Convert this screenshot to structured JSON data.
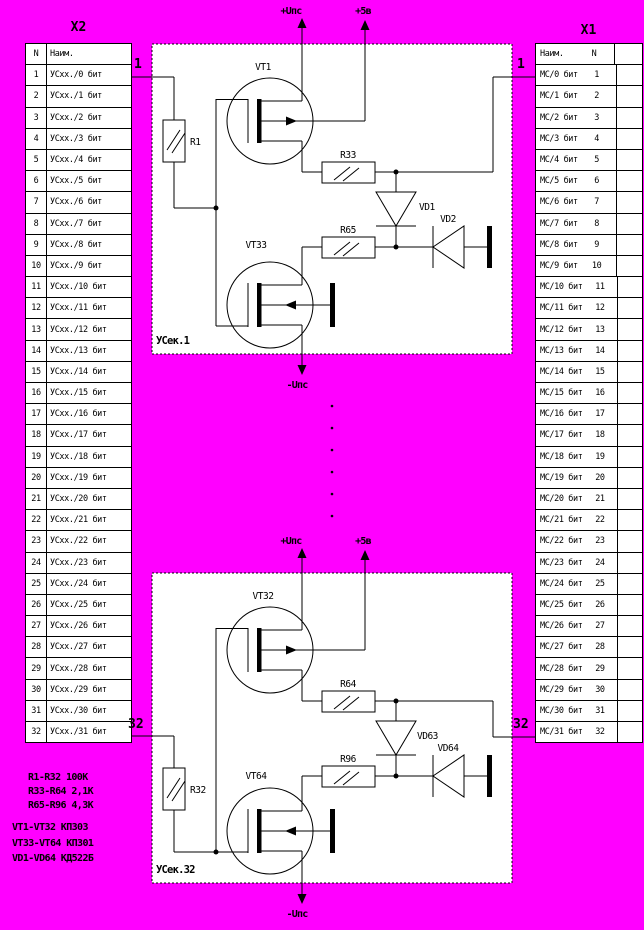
{
  "colors": {
    "background": "#FF00FF",
    "paper": "#FFFFFF",
    "ink": "#000000"
  },
  "left_connector": {
    "title": "X2",
    "col_headers": [
      "N",
      "Наим."
    ],
    "pin_top": "1",
    "pin_bottom": "32",
    "rows": [
      {
        "n": "1",
        "name": "УСхх./0 бит"
      },
      {
        "n": "2",
        "name": "УСхх./1 бит"
      },
      {
        "n": "3",
        "name": "УСхх./2 бит"
      },
      {
        "n": "4",
        "name": "УСхх./3 бит"
      },
      {
        "n": "5",
        "name": "УСхх./4 бит"
      },
      {
        "n": "6",
        "name": "УСхх./5 бит"
      },
      {
        "n": "7",
        "name": "УСхх./6 бит"
      },
      {
        "n": "8",
        "name": "УСхх./7 бит"
      },
      {
        "n": "9",
        "name": "УСхх./8 бит"
      },
      {
        "n": "10",
        "name": "УСхх./9 бит"
      },
      {
        "n": "11",
        "name": "УСхх./10 бит"
      },
      {
        "n": "12",
        "name": "УСхх./11 бит"
      },
      {
        "n": "13",
        "name": "УСхх./12 бит"
      },
      {
        "n": "14",
        "name": "УСхх./13 бит"
      },
      {
        "n": "15",
        "name": "УСхх./14 бит"
      },
      {
        "n": "16",
        "name": "УСхх./15 бит"
      },
      {
        "n": "17",
        "name": "УСхх./16 бит"
      },
      {
        "n": "18",
        "name": "УСхх./17 бит"
      },
      {
        "n": "19",
        "name": "УСхх./18 бит"
      },
      {
        "n": "20",
        "name": "УСхх./19 бит"
      },
      {
        "n": "21",
        "name": "УСхх./20 бит"
      },
      {
        "n": "22",
        "name": "УСхх./21 бит"
      },
      {
        "n": "23",
        "name": "УСхх./22 бит"
      },
      {
        "n": "24",
        "name": "УСхх./23 бит"
      },
      {
        "n": "25",
        "name": "УСхх./24 бит"
      },
      {
        "n": "26",
        "name": "УСхх./25 бит"
      },
      {
        "n": "27",
        "name": "УСхх./26 бит"
      },
      {
        "n": "28",
        "name": "УСхх./27 бит"
      },
      {
        "n": "29",
        "name": "УСхх./28 бит"
      },
      {
        "n": "30",
        "name": "УСхх./29 бит"
      },
      {
        "n": "31",
        "name": "УСхх./30 бит"
      },
      {
        "n": "32",
        "name": "УСхх./31 бит"
      }
    ]
  },
  "right_connector": {
    "title": "X1",
    "col_headers": [
      "Наим.",
      "N"
    ],
    "pin_top": "1",
    "pin_bottom": "32",
    "rows": [
      {
        "name": "МС/0 бит",
        "n": "1"
      },
      {
        "name": "МС/1 бит",
        "n": "2"
      },
      {
        "name": "МС/2 бит",
        "n": "3"
      },
      {
        "name": "МС/3 бит",
        "n": "4"
      },
      {
        "name": "МС/4 бит",
        "n": "5"
      },
      {
        "name": "МС/5 бит",
        "n": "6"
      },
      {
        "name": "МС/6 бит",
        "n": "7"
      },
      {
        "name": "МС/7 бит",
        "n": "8"
      },
      {
        "name": "МС/8 бит",
        "n": "9"
      },
      {
        "name": "МС/9 бит",
        "n": "10"
      },
      {
        "name": "МС/10 бит",
        "n": "11"
      },
      {
        "name": "МС/11 бит",
        "n": "12"
      },
      {
        "name": "МС/12 бит",
        "n": "13"
      },
      {
        "name": "МС/13 бит",
        "n": "14"
      },
      {
        "name": "МС/14 бит",
        "n": "15"
      },
      {
        "name": "МС/15 бит",
        "n": "16"
      },
      {
        "name": "МС/16 бит",
        "n": "17"
      },
      {
        "name": "МС/17 бит",
        "n": "18"
      },
      {
        "name": "МС/18 бит",
        "n": "19"
      },
      {
        "name": "МС/19 бит",
        "n": "20"
      },
      {
        "name": "МС/20 бит",
        "n": "21"
      },
      {
        "name": "МС/21 бит",
        "n": "22"
      },
      {
        "name": "МС/22 бит",
        "n": "23"
      },
      {
        "name": "МС/23 бит",
        "n": "24"
      },
      {
        "name": "МС/24 бит",
        "n": "25"
      },
      {
        "name": "МС/25 бит",
        "n": "26"
      },
      {
        "name": "МС/26 бит",
        "n": "27"
      },
      {
        "name": "МС/27 бит",
        "n": "28"
      },
      {
        "name": "МС/28 бит",
        "n": "29"
      },
      {
        "name": "МС/29 бит",
        "n": "30"
      },
      {
        "name": "МС/30 бит",
        "n": "31"
      },
      {
        "name": "МС/31 бит",
        "n": "32"
      }
    ]
  },
  "sections": [
    {
      "label": "УСек.1",
      "vt_top": "VT1",
      "vt_bottom": "VT33",
      "r_input": "R1",
      "r_top": "R33",
      "r_bottom": "R65",
      "vd_vertical": "VD1",
      "vd_horizontal": "VD2",
      "rail_plus": "+Uпс",
      "rail_5v": "+5в",
      "rail_minus": "-Uпс"
    },
    {
      "label": "УСек.32",
      "vt_top": "VT32",
      "vt_bottom": "VT64",
      "r_input": "R32",
      "r_top": "R64",
      "r_bottom": "R96",
      "vd_vertical": "VD63",
      "vd_horizontal": "VD64",
      "rail_plus": "+Uпс",
      "rail_5v": "+5в",
      "rail_minus": "-Uпс"
    }
  ],
  "notes": {
    "resistor_values": [
      "R1-R32 100К",
      "R33-R64 2,1К",
      "R65-R96 4,3К"
    ],
    "part_types": [
      "VT1-VT32 КП303",
      "VT33-VT64 КП301",
      "VD1-VD64 КД522Б"
    ]
  }
}
